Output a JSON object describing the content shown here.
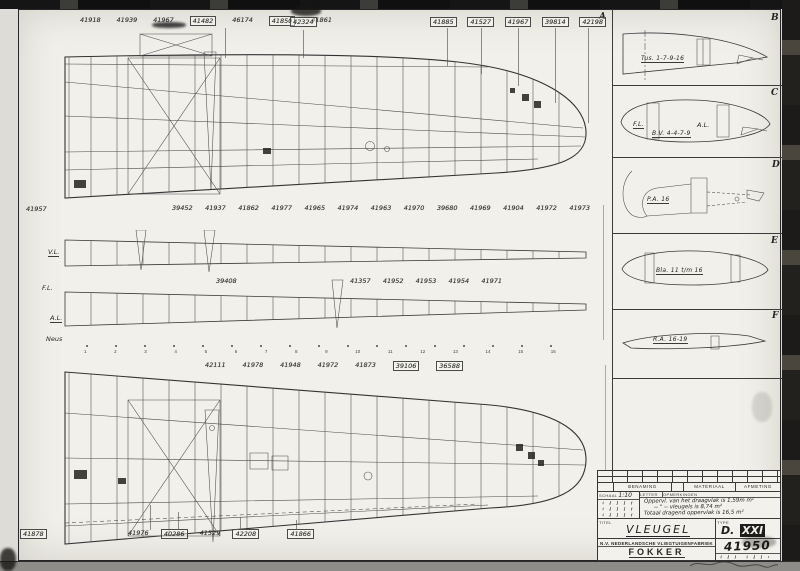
{
  "drawing": {
    "letters": {
      "a": "A",
      "b": "B",
      "c": "C",
      "d": "D",
      "e": "E",
      "f": "F"
    },
    "section_captions": {
      "b": "Tus. 1-7-9-16",
      "c": "B.V. 4-4-7-9",
      "c_fl": "F.L.",
      "c_al": "A.L.",
      "d": "P.A. 16",
      "e": "Bla. 11 t/m 16",
      "f": "R.A. 16-19"
    },
    "spar_labels": {
      "vl": "V.L.",
      "fl": "F.L.",
      "al": "A.L.",
      "neus": "Neus"
    },
    "standalone": {
      "n41957": "41957",
      "n42324": "42324",
      "n39408": "39408",
      "n41878": "41878"
    },
    "rows": {
      "top_left": [
        {
          "label": "41918"
        },
        {
          "label": "41939"
        },
        {
          "label": "41967"
        },
        {
          "label": "41482",
          "boxed": true
        },
        {
          "label": "46174"
        },
        {
          "label": "41850",
          "boxed": true
        },
        {
          "label": "41861"
        }
      ],
      "top_right": [
        {
          "label": "41885",
          "boxed": true
        },
        {
          "label": "41527",
          "boxed": true
        },
        {
          "label": "41967",
          "boxed": true
        },
        {
          "label": "39814",
          "boxed": true
        },
        {
          "label": "42198",
          "boxed": true
        }
      ],
      "mid": [
        {
          "label": "39452"
        },
        {
          "label": "41937"
        },
        {
          "label": "41862"
        },
        {
          "label": "41977"
        },
        {
          "label": "41965"
        },
        {
          "label": "41974"
        },
        {
          "label": "41963"
        },
        {
          "label": "41970"
        },
        {
          "label": "39680"
        },
        {
          "label": "41969"
        },
        {
          "label": "41904"
        },
        {
          "label": "41972"
        },
        {
          "label": "41973"
        }
      ],
      "spar": [
        {
          "label": "41357"
        },
        {
          "label": "41952"
        },
        {
          "label": "41953"
        },
        {
          "label": "41954"
        },
        {
          "label": "41971"
        }
      ],
      "lower": [
        {
          "label": "42111"
        },
        {
          "label": "41978"
        },
        {
          "label": "41948"
        },
        {
          "label": "41972"
        },
        {
          "label": "41873"
        },
        {
          "label": "39106",
          "boxed": true
        },
        {
          "label": "36588",
          "boxed": true
        }
      ],
      "bottom": [
        {
          "label": "41976"
        },
        {
          "label": "40286",
          "boxed": true
        },
        {
          "label": "41529"
        },
        {
          "label": "42208",
          "boxed": true
        },
        {
          "label": "41866",
          "boxed": true,
          "gap": true
        }
      ],
      "stations": [
        "1",
        "2",
        "3",
        "4",
        "5",
        "6",
        "7",
        "8",
        "9",
        "10",
        "11",
        "12",
        "13",
        "14",
        "15",
        "16"
      ]
    }
  },
  "title_block": {
    "benaming": "BENAMING",
    "materiaal": "MATERIAAL",
    "afmeting": "AFMETING",
    "schaal_label": "SCHAAL",
    "schaal_value": "1:10",
    "letter_label": "LETTER",
    "opmerkingen_label": "OPMERKINGEN",
    "notes": [
      "Oppervl. van het draagvlak is 1,59m m²",
      "-- \" -- vleugels is 8,74 m²",
      "Totaal dragend oppervlak is 16,5 m²"
    ],
    "titel_label": "TITEL",
    "titel_value": "VLEUGEL",
    "type_label": "TYPE",
    "type_d": "D.",
    "type_roman": "XXI",
    "company": "N.V. NEDERLANDSCHE VLIEGTUIGENFABRIEK",
    "brand": "FOKKER",
    "number": "41950"
  }
}
